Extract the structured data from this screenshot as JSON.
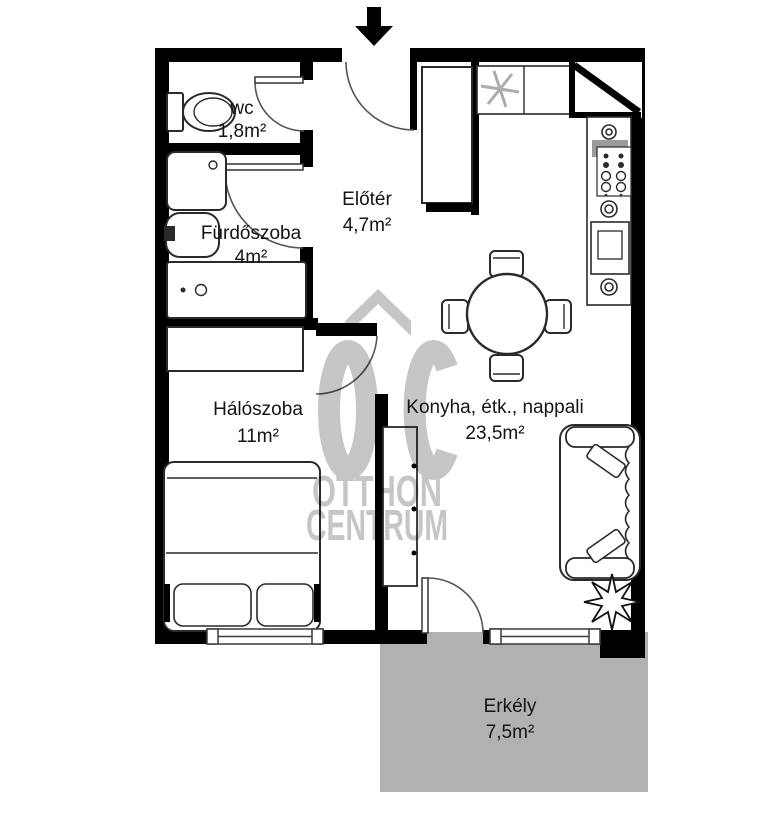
{
  "brand": {
    "initials": "OC",
    "line1": "OTTHON",
    "line2": "CENTRUM"
  },
  "entrance": {
    "symbol": "down-arrow"
  },
  "rooms": [
    {
      "name": "wc",
      "area": "1,8m²"
    },
    {
      "name": "Fürdőszoba",
      "area": "4m²"
    },
    {
      "name": "Előtér",
      "area": "4,7m²"
    },
    {
      "name": "Hálószoba",
      "area": "11m²"
    },
    {
      "name": "Konyha, étk., nappali",
      "area": "23,5m²"
    },
    {
      "name": "Erkély",
      "area": "7,5m²"
    }
  ],
  "colors": {
    "wall": "#000000",
    "balcony": "#b1b1b1",
    "watermark": "#c6c6c6",
    "fixture": "#2a2a2a",
    "sink": "#9b9b9b"
  },
  "icons": {
    "entrance": "entrance-arrow-icon",
    "freezer": "snowflake-icon",
    "plant": "plant-icon"
  }
}
